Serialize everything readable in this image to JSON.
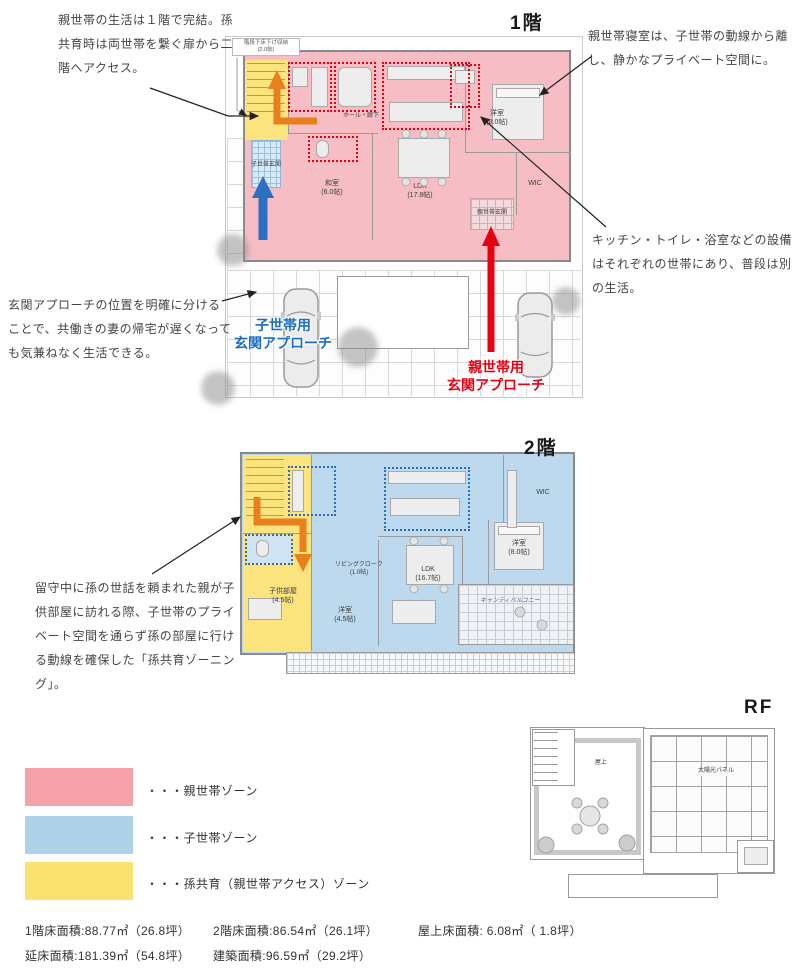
{
  "annotations": {
    "life_complete": "親世帯の生活は１階で完結。孫共育時は両世帯を繋ぐ扉から二階へアクセス。",
    "parent_bedroom": "親世帯寝室は、子世帯の動線から離し、静かなプライベート空間に。",
    "facilities": "キッチン・トイレ・浴室などの設備はそれぞれの世帯にあり、普段は別の生活。",
    "entrance_approach": "玄関アプローチの位置を明確に分けることで、共働きの妻の帰宅が遅くなっても気兼ねなく生活できる。",
    "grandchild_zoning": "留守中に孫の世話を頼まれた親が子供部屋に訪れる際、子世帯のプライベート空間を通らず孫の部屋に行ける動線を確保した「孫共育ゾーニング」。"
  },
  "floor1": {
    "title": "1階",
    "approach_child_line1": "子世帯用",
    "approach_child_line2": "玄関アプローチ",
    "approach_parent_line1": "親世帯用",
    "approach_parent_line2": "玄関アプローチ",
    "rooms": {
      "stair_storage_name": "階段下床下げ収納",
      "stair_storage_size": "(2.0帖)",
      "hall": "ホール・廊下",
      "washitsu_name": "和室",
      "washitsu_size": "(6.0帖)",
      "ldk_name": "LDK",
      "ldk_size": "(17.8帖)",
      "bedroom_name": "洋室",
      "bedroom_size": "(8.0帖)",
      "wic": "WIC",
      "parent_entrance": "親世帯玄関",
      "child_entrance": "子世帯玄関"
    }
  },
  "floor2": {
    "title": "2階",
    "rooms": {
      "living_cloak_name": "リビングクローク",
      "living_cloak_size": "(1.0帖)",
      "kids_room_name": "子供部屋",
      "kids_room_size": "(4.5帖)",
      "bedroom_small_name": "洋室",
      "bedroom_small_size": "(4.5帖)",
      "ldk_name": "LDK",
      "ldk_size": "(16.7帖)",
      "bedroom_main_name": "洋室",
      "bedroom_main_size": "(8.0帖)",
      "wic": "WIC",
      "balcony": "キャンティバルコニー"
    }
  },
  "roof": {
    "title": "RF",
    "rooms": {
      "rooftop": "屋上",
      "solar_panel": "太陽光パネル"
    }
  },
  "legend": {
    "items": [
      {
        "label": "・・・親世帯ゾーン",
        "color": "#f5a2ad"
      },
      {
        "label": "・・・子世帯ゾーン",
        "color": "#afd2e8"
      },
      {
        "label": "・・・孫共育（親世帯アクセス）ゾーン",
        "color": "#fbe170"
      }
    ]
  },
  "stats": {
    "floor1_area": "1階床面積:88.77㎡（26.8坪）",
    "floor2_area": "2階床面積:86.54㎡（26.1坪）",
    "roof_area": "屋上床面積: 6.08㎡（ 1.8坪）",
    "total_area": "延床面積:181.39㎡（54.8坪）",
    "building_area": "建築面積:96.59㎡（29.2坪）"
  },
  "colors": {
    "parent_zone_fill": "#f6bdc5",
    "child_zone_fill": "#bcd9ee",
    "grandchild_zone_fill": "#fbe37e",
    "accent_red": "#e60012",
    "accent_blue": "#1c6cc3",
    "accent_orange": "#e8801e"
  }
}
